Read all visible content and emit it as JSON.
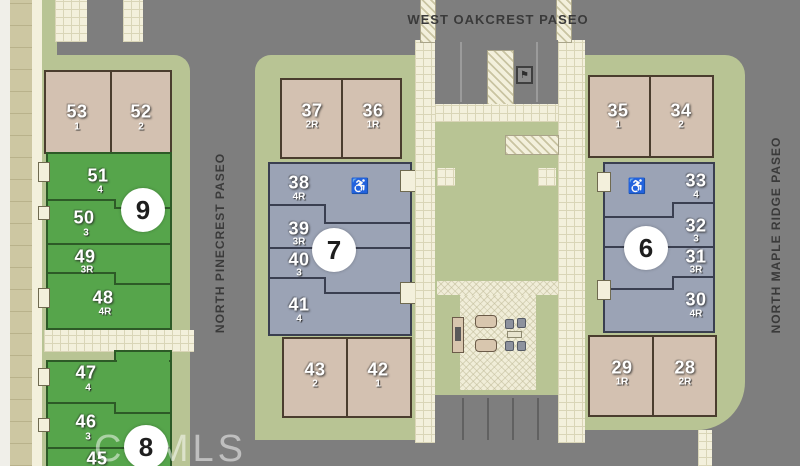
{
  "title": "Community site plan",
  "streets": {
    "top": "WEST OAKCREST PASEO",
    "left": "NORTH PINECREST PASEO",
    "right": "NORTH MAPLE RIDGE PASEO"
  },
  "watermark": "CRMLS",
  "markers": {
    "m9": "9",
    "m8": "8",
    "m7": "7",
    "m6": "6"
  },
  "icons": {
    "accessibility": "♿",
    "parking_sign": "⚑"
  },
  "colors": {
    "street_gray": "#7e7e7e",
    "tan_unit": "#d3c1b1",
    "green_unit": "#56a54b",
    "slate_unit": "#9ba3b5",
    "landscape_green": "#b8c494",
    "paver_cream": "#f3f0dc"
  },
  "units": {
    "u53": {
      "lot": "53",
      "plan": "1"
    },
    "u52": {
      "lot": "52",
      "plan": "2"
    },
    "u51": {
      "lot": "51",
      "plan": "4"
    },
    "u50": {
      "lot": "50",
      "plan": "3"
    },
    "u49": {
      "lot": "49",
      "plan": "3R"
    },
    "u48": {
      "lot": "48",
      "plan": "4R"
    },
    "u47": {
      "lot": "47",
      "plan": "4"
    },
    "u46": {
      "lot": "46",
      "plan": "3"
    },
    "u45": {
      "lot": "45",
      "plan": ""
    },
    "u37": {
      "lot": "37",
      "plan": "2R"
    },
    "u36": {
      "lot": "36",
      "plan": "1R"
    },
    "u38": {
      "lot": "38",
      "plan": "4R"
    },
    "u39": {
      "lot": "39",
      "plan": "3R"
    },
    "u40": {
      "lot": "40",
      "plan": "3"
    },
    "u41": {
      "lot": "41",
      "plan": "4"
    },
    "u43": {
      "lot": "43",
      "plan": "2"
    },
    "u42": {
      "lot": "42",
      "plan": "1"
    },
    "u35": {
      "lot": "35",
      "plan": "1"
    },
    "u34": {
      "lot": "34",
      "plan": "2"
    },
    "u33": {
      "lot": "33",
      "plan": "4"
    },
    "u32": {
      "lot": "32",
      "plan": "3"
    },
    "u31": {
      "lot": "31",
      "plan": "3R"
    },
    "u30": {
      "lot": "30",
      "plan": "4R"
    },
    "u29": {
      "lot": "29",
      "plan": "1R"
    },
    "u28": {
      "lot": "28",
      "plan": "2R"
    }
  }
}
